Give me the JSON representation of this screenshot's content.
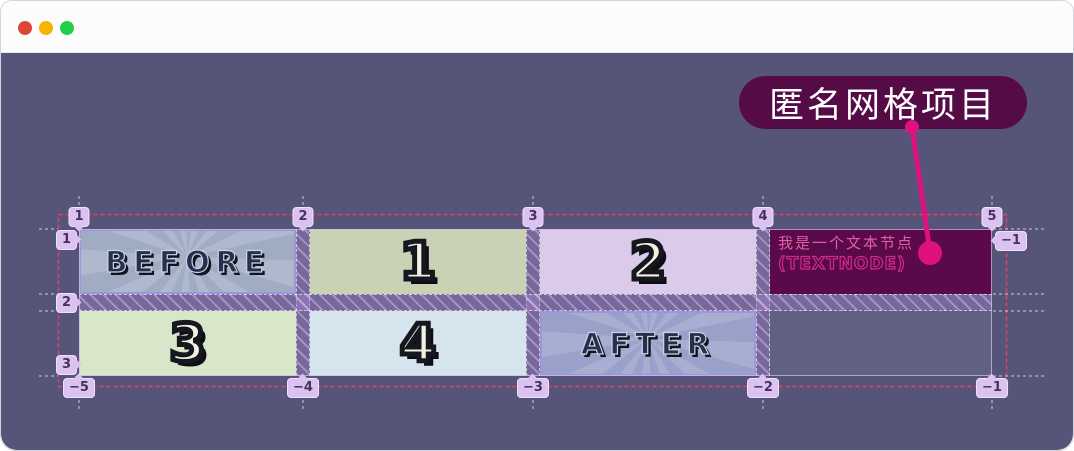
{
  "titlebar": {
    "buttons": [
      {
        "name": "close",
        "color": "#dd4733"
      },
      {
        "name": "minimize",
        "color": "#f7b500"
      },
      {
        "name": "zoom",
        "color": "#23cf4a"
      }
    ]
  },
  "callout": {
    "label": "匿名网格项目",
    "bg": "#550b46",
    "accent": "#e0117f"
  },
  "grid": {
    "lines": {
      "top": [
        "1",
        "2",
        "3",
        "4",
        "5"
      ],
      "left": [
        "1",
        "2",
        "3"
      ],
      "bottom": [
        "−5",
        "−4",
        "−3",
        "−2",
        "−1"
      ],
      "right": [
        "−1"
      ]
    },
    "cells": {
      "before": {
        "label": "BEFORE"
      },
      "item1": {
        "label": "1"
      },
      "item2": {
        "label": "2"
      },
      "textnode": {
        "line1": "我是一个文本节点",
        "line2": "(TEXTNODE)"
      },
      "item3": {
        "label": "3"
      },
      "item4": {
        "label": "4"
      },
      "after": {
        "label": "AFTER"
      },
      "empty": {
        "label": ""
      }
    }
  },
  "colors": {
    "panel_bg": "#565478",
    "container_border_dashed": "#e8415f",
    "marker_bg": "#dcc2f0",
    "cell_item1_bg": "#c9d2b4",
    "cell_item2_bg": "#dccaeb",
    "cell_item3_bg": "#d8e6c9",
    "cell_item4_bg": "#d6e5ed",
    "cell_textnode_bg": "#5a0a4a",
    "textnode_text": "#e260a2",
    "callout_bg": "#550b46",
    "callout_pointer": "#e0117f"
  }
}
